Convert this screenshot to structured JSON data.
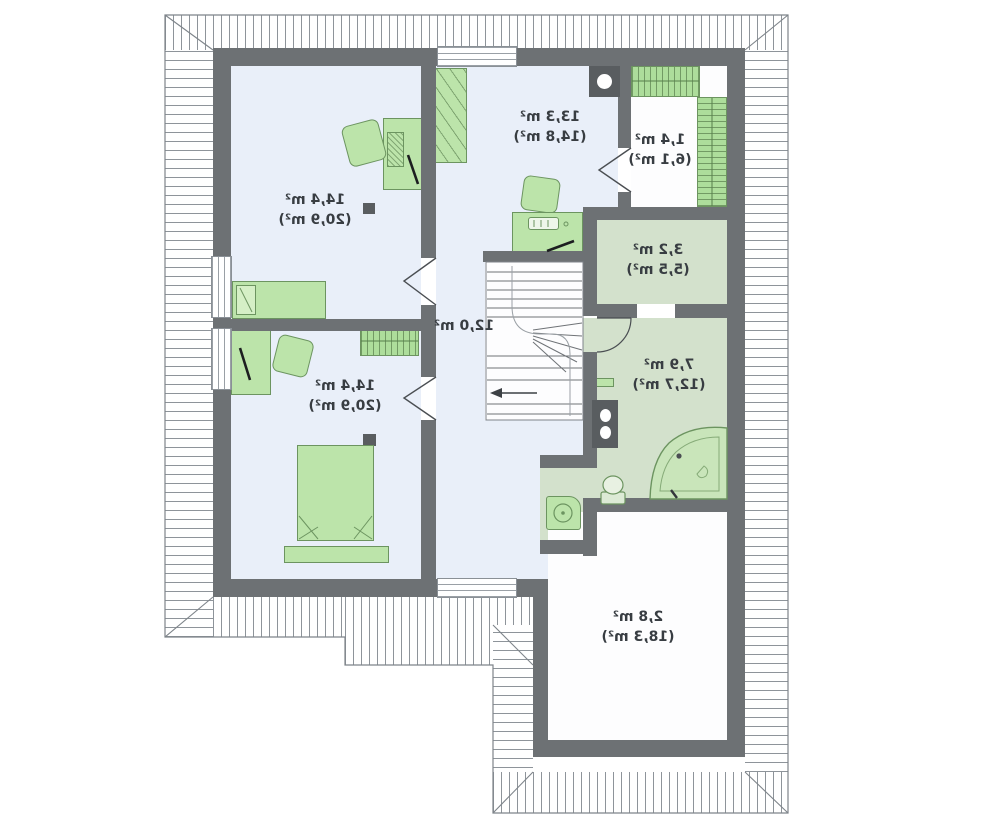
{
  "meta": {
    "type": "floor-plan",
    "level": "attic-storey",
    "units": "m²",
    "text_mirrored": true
  },
  "colors": {
    "wall": "#6d7174",
    "roof_hatch_line": "#8e949a",
    "floor_blue": "#e9eff9",
    "floor_green": "#d3e1cc",
    "furniture_green": "#bce4aa",
    "furniture_stroke": "#6c9460",
    "label_text": "#383d42"
  },
  "rooms": [
    {
      "id": "bedroom-top-left",
      "area": "14,4 m²",
      "area_total": "(20,9 m²)"
    },
    {
      "id": "bedroom-top-middle",
      "area": "13,3 m²",
      "area_total": "(14,8 m²)"
    },
    {
      "id": "wardrobe-room",
      "area": "1,4 m²",
      "area_total": "(6,1 m²)"
    },
    {
      "id": "storage-room",
      "area": "3,2 m²",
      "area_total": "(5,5 m²)"
    },
    {
      "id": "bathroom",
      "area": "7,9 m²",
      "area_total": "(12,7 m²)"
    },
    {
      "id": "hall-staircase",
      "area": "12,0 m²",
      "area_total": ""
    },
    {
      "id": "bedroom-bottom-left",
      "area": "14,4 m²",
      "area_total": "(20,9 m²)"
    },
    {
      "id": "attic-over-garage",
      "area": "2,8 m²",
      "area_total": "(18,3 m²)"
    }
  ],
  "icons": [
    "roof-hatch",
    "chimney-icon",
    "flue-icon",
    "window-icon",
    "door-opening-icon",
    "door-swing-icon",
    "stairs-icon",
    "stairs-direction-arrow-icon",
    "bed-icon",
    "double-bed-icon",
    "desk-icon",
    "armchair-icon",
    "desk-chair-icon",
    "wardrobe-icon",
    "closet-shelves-icon",
    "bench-icon",
    "nightstand-icon",
    "corner-bathtub-icon",
    "toilet-icon",
    "washing-machine-icon",
    "keyboard-icon",
    "pen-icon"
  ]
}
